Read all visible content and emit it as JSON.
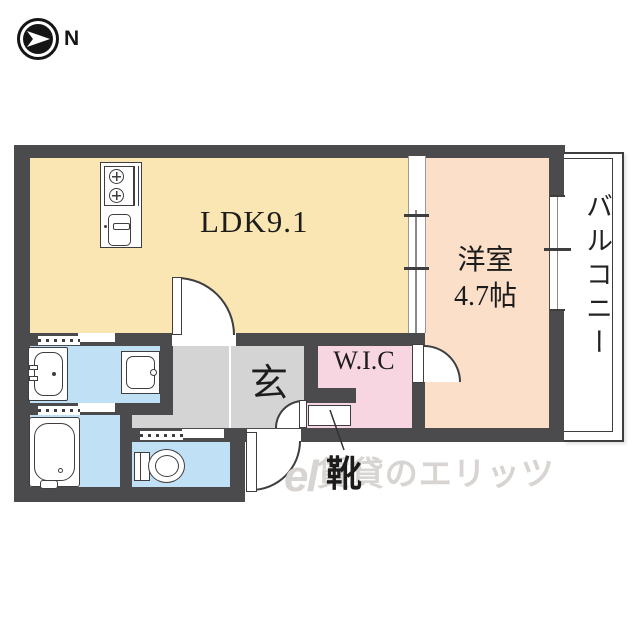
{
  "compass": {
    "north_label": "N"
  },
  "plan": {
    "ldk_label": "LDK9.1",
    "bedroom_name": "洋室",
    "bedroom_size": "4.7帖",
    "balcony_label": "バルコニー",
    "entrance_label": "玄",
    "wic_label": "W.I.C",
    "shoe_label": "靴"
  },
  "watermark": {
    "logo_script": "el",
    "text": "賃貸のエリッツ"
  },
  "colors": {
    "wall": "#4b4b4d",
    "line": "#3e3e40",
    "ldk": "#f9e6b2",
    "bedroom": "#fbdfc9",
    "wic": "#f7d5e1",
    "wet": "#bfe0f5",
    "hall": "#d4d4d5",
    "watermark": "#d8d4d1",
    "text": "#1c1c1c"
  }
}
